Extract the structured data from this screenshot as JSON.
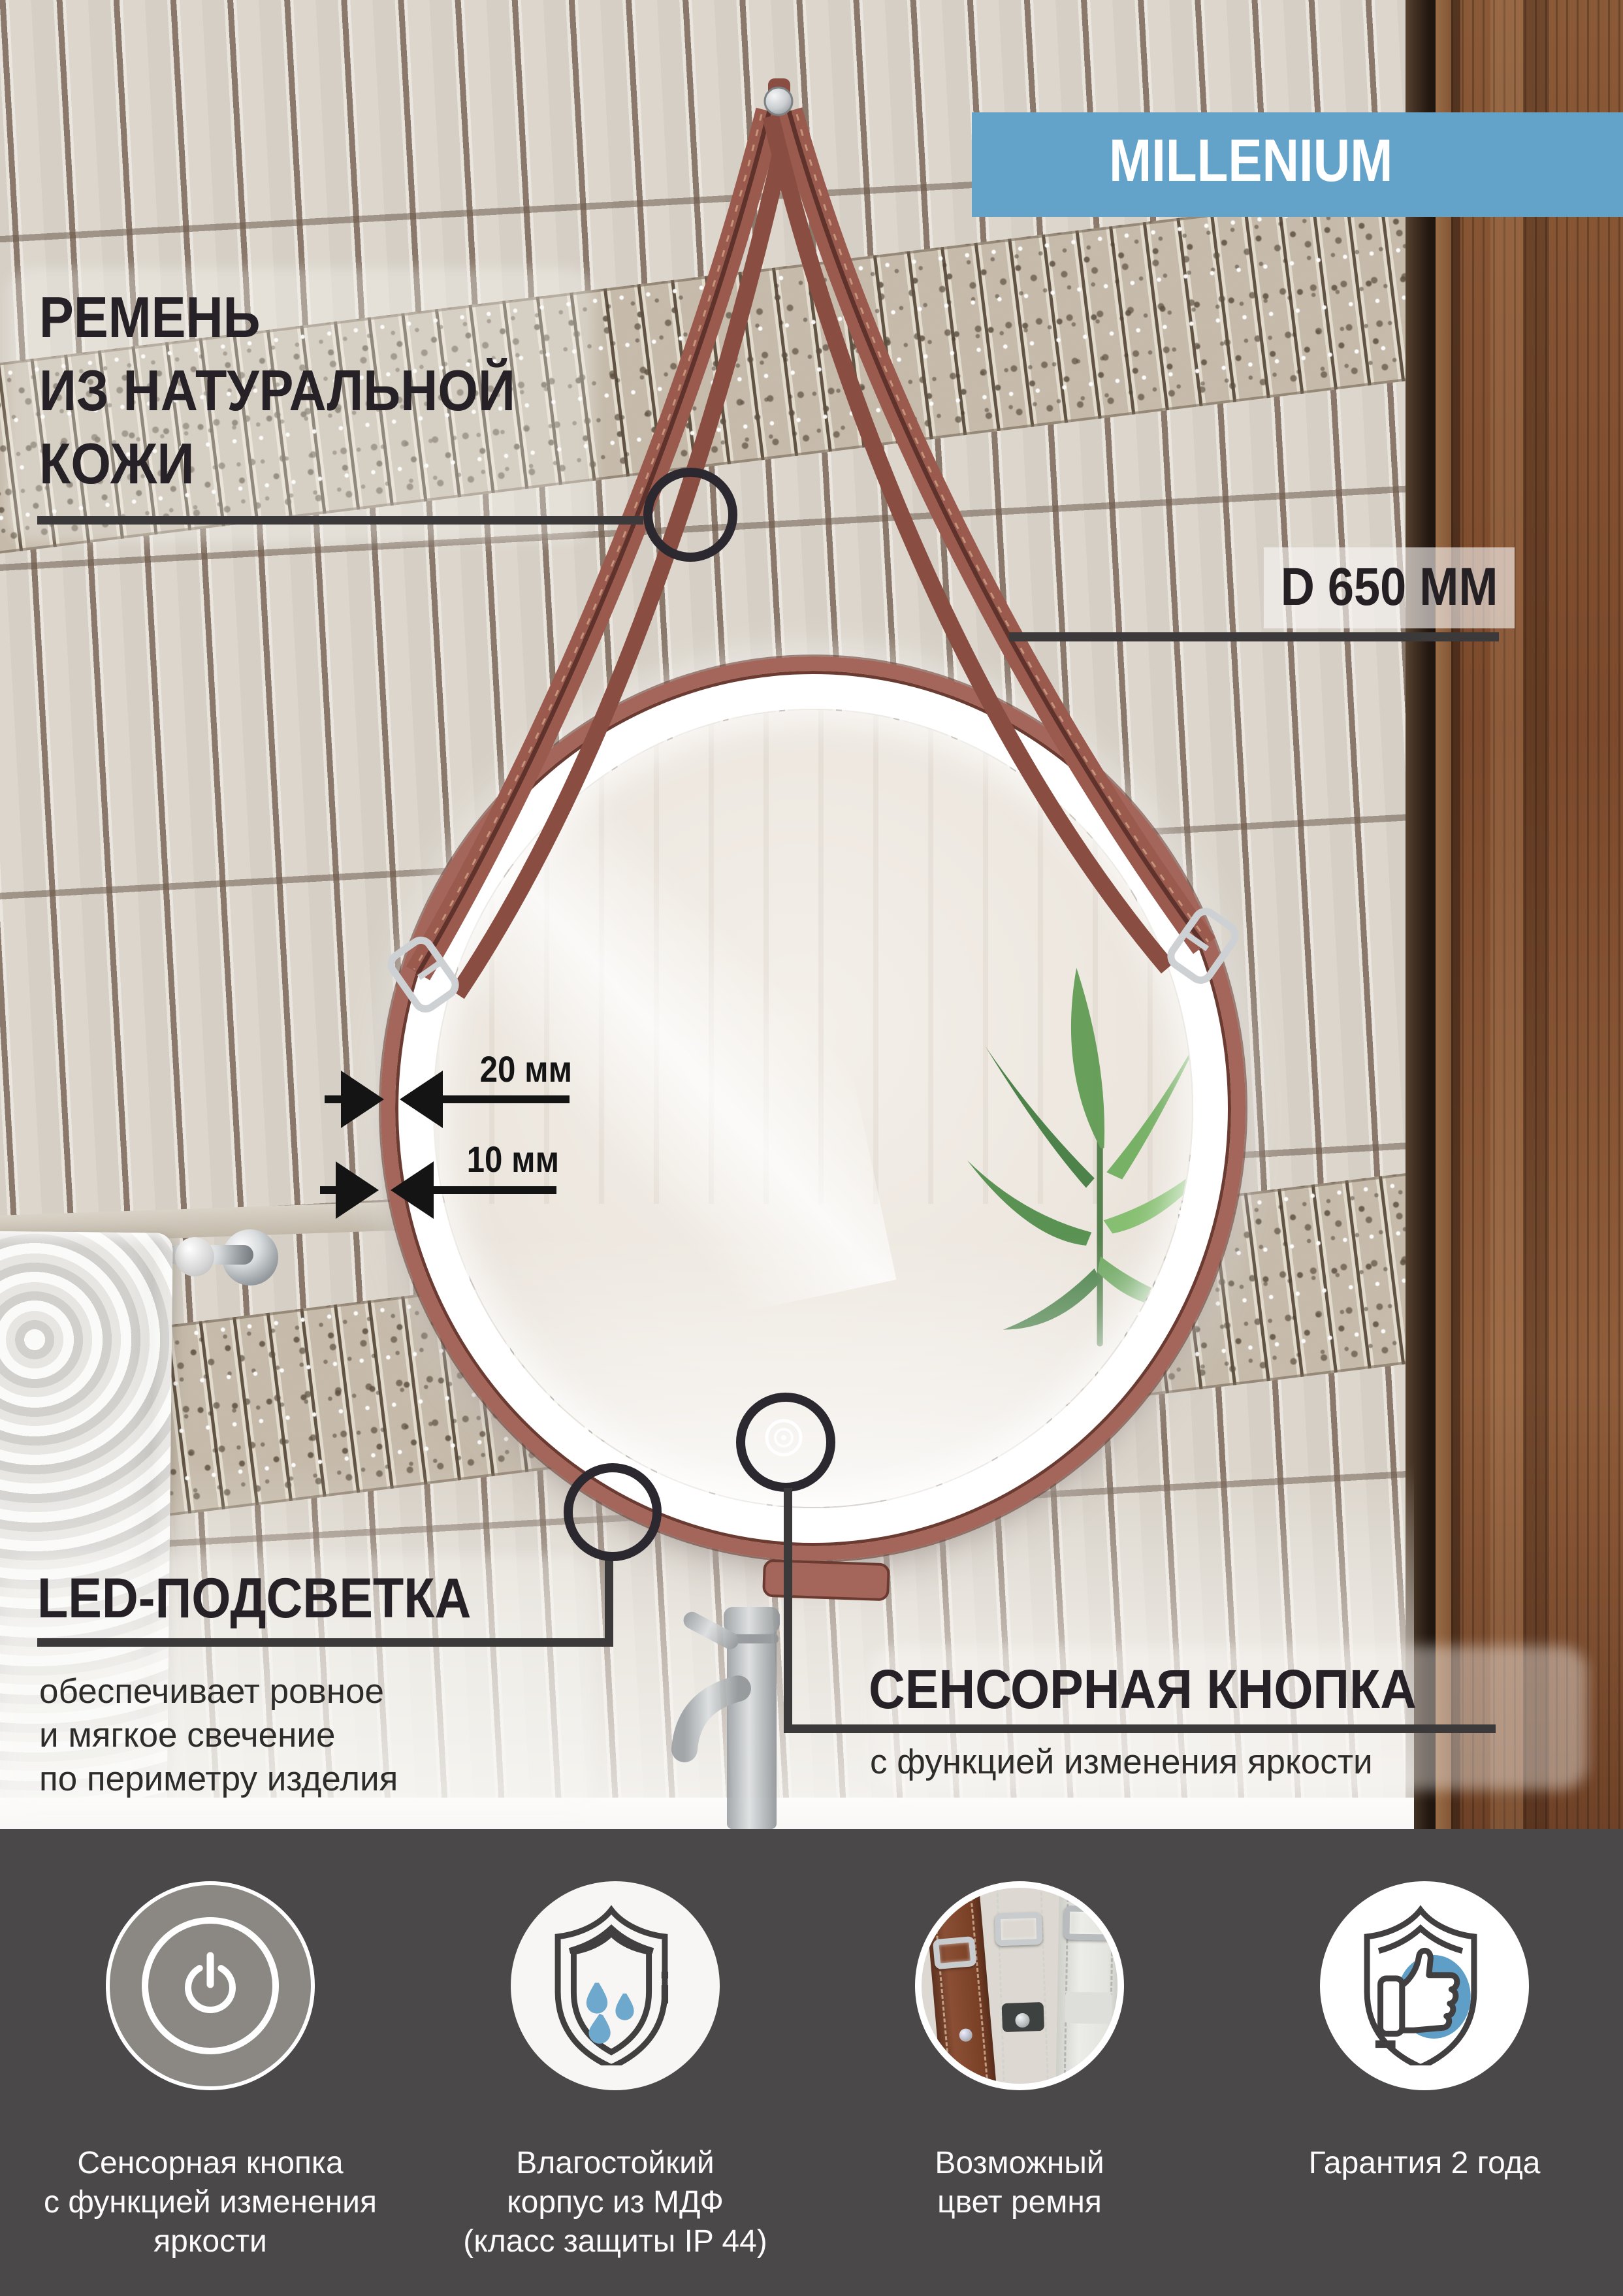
{
  "badge": {
    "label": "MILLENIUM",
    "bg": "#64a3c9"
  },
  "callouts": {
    "strap": {
      "lines": [
        "РЕМЕНЬ",
        "ИЗ НАТУРАЛЬНОЙ",
        "КОЖИ"
      ]
    },
    "diameter": {
      "label": "D 650 ММ"
    },
    "dim20": {
      "label": "20 мм"
    },
    "dim10": {
      "label": "10 мм"
    },
    "led": {
      "title": "LED-ПОДСВЕТКА",
      "lines": [
        "обеспечивает ровное",
        "и мягкое свечение",
        "по периметру изделия"
      ]
    },
    "sensor": {
      "title": "СЕНСОРНАЯ КНОПКА",
      "subtitle": "с функцией изменения яркости"
    }
  },
  "features": [
    {
      "icon": "touch-power-button-icon",
      "lines": [
        "Сенсорная кнопка",
        "с функцией изменения",
        "яркости"
      ]
    },
    {
      "icon": "moisture-shield-icon",
      "lines": [
        "Влагостойкий",
        "корпус из МДФ",
        "(класс защиты IP 44)"
      ]
    },
    {
      "icon": "strap-colors-photo",
      "lines": [
        "Возможный",
        "цвет ремня"
      ]
    },
    {
      "icon": "warranty-shield-icon",
      "lines": [
        "Гарантия 2 года"
      ]
    }
  ],
  "colors": {
    "accent_blue": "#64a3c9",
    "band_bg": "#4a4849",
    "strap_leather": "#9a5b4e",
    "callout_line": "#3b393a",
    "drops_blue": "#6ea9cd"
  }
}
